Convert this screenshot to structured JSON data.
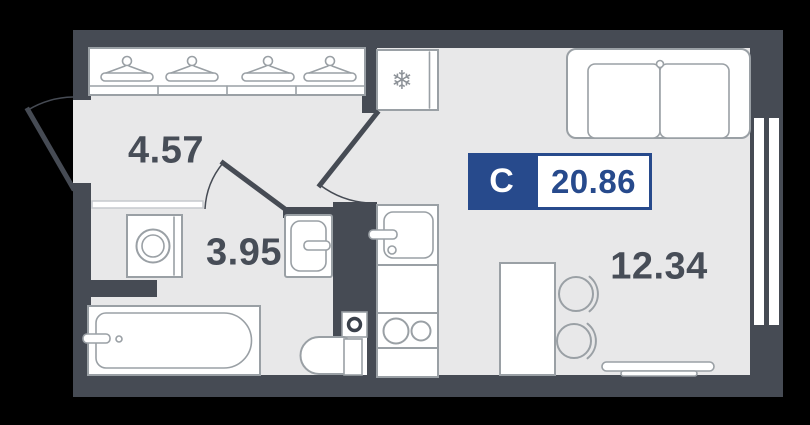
{
  "floor_plan": {
    "unit": {
      "type_abbr": "С",
      "total_area": "20.86"
    },
    "rooms": [
      {
        "id": "hallway",
        "area": "4.57"
      },
      {
        "id": "bathroom",
        "area": "3.95"
      },
      {
        "id": "living-room",
        "area": "12.34"
      }
    ],
    "icons": {
      "freezer_snowflake": "❄",
      "hangers_count": 4
    },
    "colors": {
      "background": "#000000",
      "wall": "#464b54",
      "floor": "#e8e8e9",
      "furniture_outline": "#9aa0a5",
      "label_text": "#474d57",
      "badge": "#274a8c"
    }
  }
}
